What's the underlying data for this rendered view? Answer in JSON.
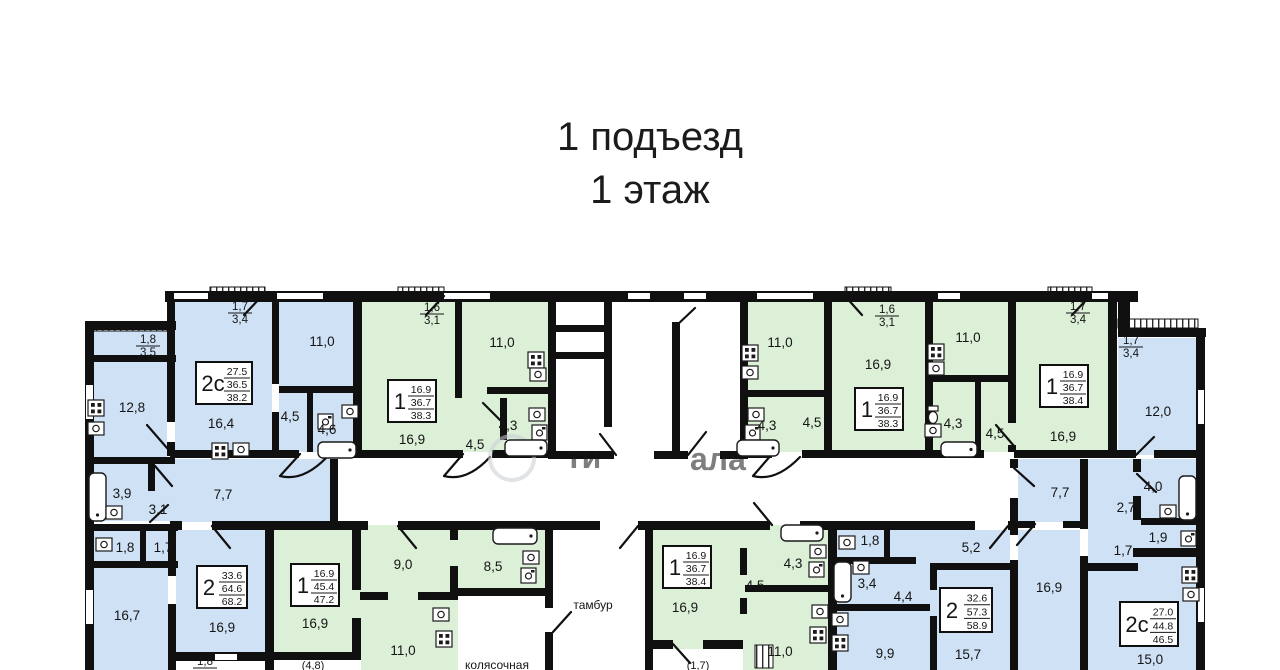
{
  "title": {
    "line1": "1 подъезд",
    "line2": "1 этаж"
  },
  "colors": {
    "blue": "#cfe1f5",
    "green": "#dcefd7",
    "wall": "#101010",
    "paper": "#ffffff"
  },
  "watermark": {
    "t1": "ти",
    "t2": "ала"
  },
  "plan": {
    "room_labels": [
      {
        "t": "11,0",
        "x": 322,
        "y": 346
      },
      {
        "t": "12,8",
        "x": 132,
        "y": 412
      },
      {
        "t": "16,4",
        "x": 221,
        "y": 428
      },
      {
        "t": "4,5",
        "x": 290,
        "y": 421
      },
      {
        "t": "4,6",
        "x": 327,
        "y": 434
      },
      {
        "t": "3,9",
        "x": 122,
        "y": 498
      },
      {
        "t": "3,1",
        "x": 158,
        "y": 514
      },
      {
        "t": "7,7",
        "x": 223,
        "y": 499
      },
      {
        "t": "11,0",
        "x": 502,
        "y": 347
      },
      {
        "t": "16,9",
        "x": 412,
        "y": 444
      },
      {
        "t": "4,5",
        "x": 475,
        "y": 449
      },
      {
        "t": "4,3",
        "x": 508,
        "y": 430
      },
      {
        "t": "11,0",
        "x": 780,
        "y": 347
      },
      {
        "t": "16,9",
        "x": 878,
        "y": 369
      },
      {
        "t": "4,3",
        "x": 767,
        "y": 430
      },
      {
        "t": "4,5",
        "x": 812,
        "y": 427
      },
      {
        "t": "11,0",
        "x": 968,
        "y": 342
      },
      {
        "t": "16,9",
        "x": 1063,
        "y": 441
      },
      {
        "t": "4,3",
        "x": 953,
        "y": 428
      },
      {
        "t": "4,5",
        "x": 995,
        "y": 438
      },
      {
        "t": "12,0",
        "x": 1158,
        "y": 416
      },
      {
        "t": "4,0",
        "x": 1153,
        "y": 491
      },
      {
        "t": "2,7",
        "x": 1126,
        "y": 512
      },
      {
        "t": "1,9",
        "x": 1158,
        "y": 542
      },
      {
        "t": "1,7",
        "x": 1123,
        "y": 555
      },
      {
        "t": "15,0",
        "x": 1150,
        "y": 664
      },
      {
        "t": "7,7",
        "x": 1060,
        "y": 497
      },
      {
        "t": "5,2",
        "x": 971,
        "y": 552
      },
      {
        "t": "1,8",
        "x": 870,
        "y": 545
      },
      {
        "t": "3,4",
        "x": 867,
        "y": 588
      },
      {
        "t": "4,4",
        "x": 903,
        "y": 601
      },
      {
        "t": "9,9",
        "x": 885,
        "y": 658
      },
      {
        "t": "15,7",
        "x": 968,
        "y": 659
      },
      {
        "t": "16,9",
        "x": 1049,
        "y": 592
      },
      {
        "t": "1,8",
        "x": 125,
        "y": 552
      },
      {
        "t": "1,7",
        "x": 163,
        "y": 552
      },
      {
        "t": "16,7",
        "x": 127,
        "y": 620
      },
      {
        "t": "16,9",
        "x": 222,
        "y": 632
      },
      {
        "t": "16,9",
        "x": 315,
        "y": 628
      },
      {
        "t": "9,0",
        "x": 403,
        "y": 569
      },
      {
        "t": "8,5",
        "x": 493,
        "y": 571
      },
      {
        "t": "11,0",
        "x": 403,
        "y": 655
      },
      {
        "t": "16,9",
        "x": 685,
        "y": 612
      },
      {
        "t": "4,5",
        "x": 755,
        "y": 590
      },
      {
        "t": "4,3",
        "x": 793,
        "y": 568
      },
      {
        "t": "11,0",
        "x": 780,
        "y": 656
      },
      {
        "t": "(4,8)",
        "x": 313,
        "y": 669,
        "s": 11
      },
      {
        "t": "(1,7)",
        "x": 698,
        "y": 669,
        "s": 11
      },
      {
        "t": "тамбур",
        "x": 593,
        "y": 609,
        "s": 12
      },
      {
        "t": "колясочная",
        "x": 497,
        "y": 669,
        "s": 12
      }
    ],
    "fraction_labels": [
      {
        "top": "1,7",
        "bot": "3,4",
        "x": 240,
        "y": 310
      },
      {
        "top": "1,8",
        "bot": "3,5",
        "x": 148,
        "y": 343
      },
      {
        "top": "1,6",
        "bot": "3,1",
        "x": 432,
        "y": 311
      },
      {
        "top": "1,6",
        "bot": "3,1",
        "x": 887,
        "y": 313
      },
      {
        "top": "1,7",
        "bot": "3,4",
        "x": 1078,
        "y": 310
      },
      {
        "top": "1,7",
        "bot": "3,4",
        "x": 1131,
        "y": 344
      },
      {
        "top": "1,8",
        "bot": "",
        "x": 205,
        "y": 665
      }
    ],
    "apartment_boxes": [
      {
        "type": "2с",
        "v1": "27.5",
        "v2": "36.5",
        "v3": "38.2",
        "x": 196,
        "y": 362,
        "w": 56,
        "h": 42
      },
      {
        "type": "1",
        "v1": "16.9",
        "v2": "36.7",
        "v3": "38.3",
        "x": 388,
        "y": 380,
        "w": 48,
        "h": 42
      },
      {
        "type": "1",
        "v1": "16.9",
        "v2": "36.7",
        "v3": "38.3",
        "x": 855,
        "y": 388,
        "w": 48,
        "h": 42
      },
      {
        "type": "1",
        "v1": "16.9",
        "v2": "36.7",
        "v3": "38.4",
        "x": 1040,
        "y": 365,
        "w": 48,
        "h": 42
      },
      {
        "type": "2",
        "v1": "33.6",
        "v2": "64.6",
        "v3": "68.2",
        "x": 197,
        "y": 566,
        "w": 50,
        "h": 42
      },
      {
        "type": "1",
        "v1": "16.9",
        "v2": "45.4",
        "v3": "47.2",
        "x": 291,
        "y": 564,
        "w": 48,
        "h": 42
      },
      {
        "type": "1",
        "v1": "16.9",
        "v2": "36.7",
        "v3": "38.4",
        "x": 663,
        "y": 546,
        "w": 48,
        "h": 42
      },
      {
        "type": "2",
        "v1": "32.6",
        "v2": "57.3",
        "v3": "58.9",
        "x": 940,
        "y": 588,
        "w": 52,
        "h": 44
      },
      {
        "type": "2с",
        "v1": "27.0",
        "v2": "44.8",
        "v3": "46.5",
        "x": 1120,
        "y": 602,
        "w": 58,
        "h": 44
      }
    ],
    "icons": [
      {
        "t": "stove-icon",
        "x": 212,
        "y": 443
      },
      {
        "t": "sink-icon",
        "x": 233,
        "y": 443
      },
      {
        "t": "stove-icon",
        "x": 88,
        "y": 400
      },
      {
        "t": "sink-icon",
        "x": 88,
        "y": 422
      },
      {
        "t": "sink-icon",
        "x": 342,
        "y": 405
      },
      {
        "t": "washer-icon",
        "x": 318,
        "y": 414
      },
      {
        "t": "tub-icon",
        "x": 318,
        "y": 442,
        "w": 38,
        "h": 16
      },
      {
        "t": "stove-icon",
        "x": 528,
        "y": 352
      },
      {
        "t": "sink-icon",
        "x": 530,
        "y": 368
      },
      {
        "t": "sink-icon",
        "x": 529,
        "y": 408
      },
      {
        "t": "washer-icon",
        "x": 532,
        "y": 425
      },
      {
        "t": "tub-icon",
        "x": 505,
        "y": 440,
        "w": 42,
        "h": 16
      },
      {
        "t": "stove-icon",
        "x": 742,
        "y": 345
      },
      {
        "t": "sink-icon",
        "x": 742,
        "y": 366
      },
      {
        "t": "sink-icon",
        "x": 748,
        "y": 408
      },
      {
        "t": "washer-icon",
        "x": 745,
        "y": 425
      },
      {
        "t": "tub-icon",
        "x": 737,
        "y": 440,
        "w": 42,
        "h": 16
      },
      {
        "t": "stove-icon",
        "x": 928,
        "y": 344
      },
      {
        "t": "sink-icon",
        "x": 928,
        "y": 362
      },
      {
        "t": "wc-icon",
        "x": 926,
        "y": 406
      },
      {
        "t": "sink-icon",
        "x": 925,
        "y": 424
      },
      {
        "t": "tub-icon",
        "x": 941,
        "y": 442,
        "w": 36,
        "h": 15
      },
      {
        "t": "tub-icon",
        "x": 1179,
        "y": 476,
        "w": 17,
        "h": 44
      },
      {
        "t": "sink-icon",
        "x": 1160,
        "y": 505
      },
      {
        "t": "washer-icon",
        "x": 1181,
        "y": 531
      },
      {
        "t": "stove-icon",
        "x": 1182,
        "y": 567
      },
      {
        "t": "sink-icon",
        "x": 1183,
        "y": 588
      },
      {
        "t": "sink-icon",
        "x": 839,
        "y": 536
      },
      {
        "t": "tub-icon",
        "x": 834,
        "y": 562,
        "w": 17,
        "h": 40
      },
      {
        "t": "sink-icon",
        "x": 853,
        "y": 561
      },
      {
        "t": "sink-icon",
        "x": 832,
        "y": 613
      },
      {
        "t": "stove-icon",
        "x": 832,
        "y": 635
      },
      {
        "t": "sink-icon",
        "x": 96,
        "y": 538
      },
      {
        "t": "tub-icon",
        "x": 89,
        "y": 473,
        "w": 17,
        "h": 48
      },
      {
        "t": "sink-icon",
        "x": 106,
        "y": 506
      },
      {
        "t": "tub-icon",
        "x": 493,
        "y": 528,
        "w": 44,
        "h": 16
      },
      {
        "t": "sink-icon",
        "x": 523,
        "y": 551
      },
      {
        "t": "washer-icon",
        "x": 521,
        "y": 568
      },
      {
        "t": "sink-icon",
        "x": 433,
        "y": 608
      },
      {
        "t": "stove-icon",
        "x": 436,
        "y": 631
      },
      {
        "t": "sink-icon",
        "x": 812,
        "y": 605
      },
      {
        "t": "stove-icon",
        "x": 810,
        "y": 627
      },
      {
        "t": "tub-icon",
        "x": 781,
        "y": 525,
        "w": 42,
        "h": 16
      },
      {
        "t": "sink-icon",
        "x": 810,
        "y": 545
      },
      {
        "t": "washer-icon",
        "x": 809,
        "y": 562
      }
    ]
  }
}
